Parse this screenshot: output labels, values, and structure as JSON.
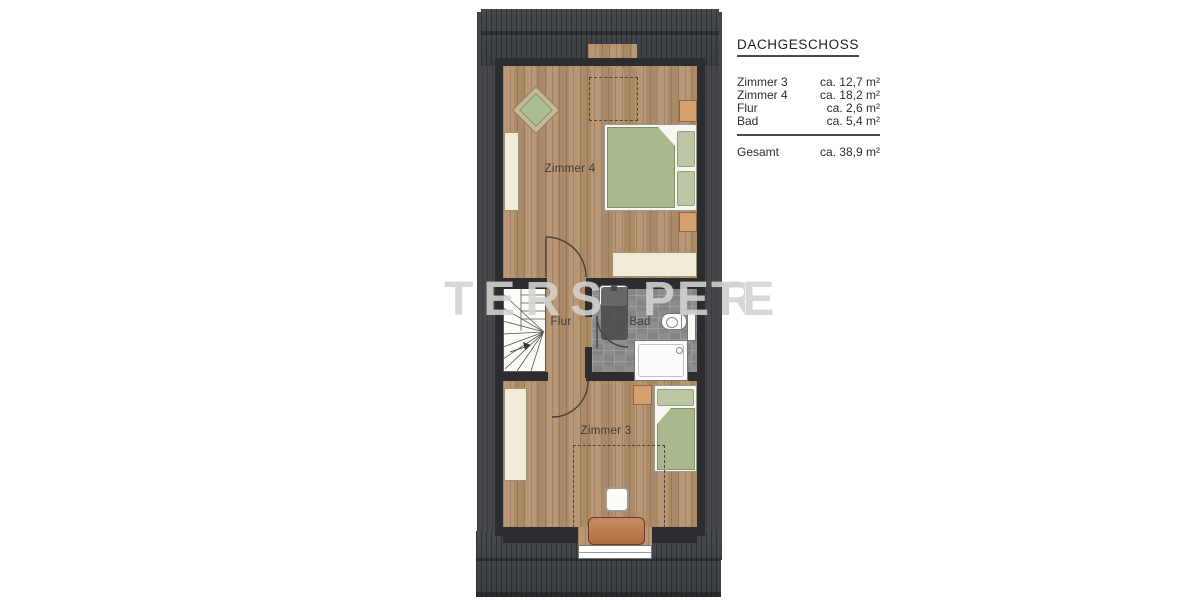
{
  "legend": {
    "title": "DACHGESCHOSS",
    "rows": [
      {
        "label": "Zimmer 3",
        "value": "ca. 12,7 m²"
      },
      {
        "label": "Zimmer 4",
        "value": "ca. 18,2 m²"
      },
      {
        "label": "Flur",
        "value": "ca. 2,6 m²"
      },
      {
        "label": "Bad",
        "value": "ca. 5,4 m²"
      }
    ],
    "total_label": "Gesamt",
    "total_value": "ca. 38,9 m²"
  },
  "room_labels": {
    "zimmer4": "Zimmer 4",
    "zimmer3": "Zimmer 3",
    "flur": "Flur",
    "bad": "Bad"
  },
  "watermark": {
    "left": "TERS",
    "right": "PETE",
    "tail": "R"
  },
  "colors": {
    "roof": "#3f4247",
    "roof_side": "#46484d",
    "wall": "#2c2d30",
    "wood_floor": "#b5916e",
    "bath_tile": "#8d8d8d",
    "bedding_green": "#a9b88e",
    "furniture_cream": "#f1ecd8",
    "furniture_wood": "#d3a06f",
    "desk_wood": "#bf7747"
  }
}
